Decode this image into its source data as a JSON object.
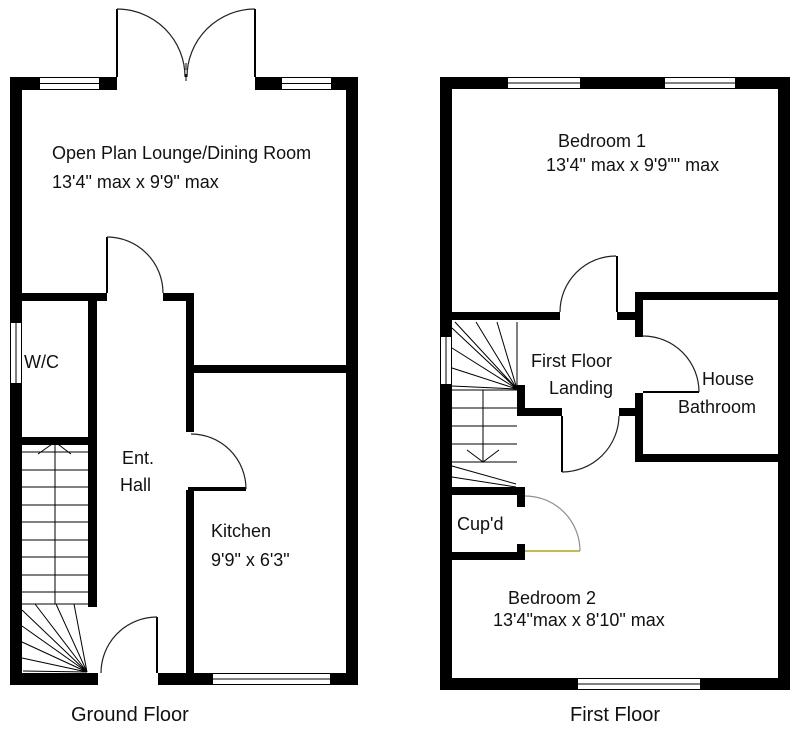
{
  "ground_floor": {
    "floor_label": "Ground Floor",
    "lounge": {
      "line1": "Open Plan Lounge/Dining Room",
      "line2": "13'4\" max x 9'9\" max"
    },
    "wc": {
      "label": "W/C"
    },
    "hall": {
      "line1": "Ent.",
      "line2": "Hall"
    },
    "kitchen": {
      "line1": "Kitchen",
      "line2": "9'9\" x 6'3\""
    }
  },
  "first_floor": {
    "floor_label": "First Floor",
    "bedroom1": {
      "line1": "Bedroom 1",
      "line2": "13'4\" max x 9'9\"\" max"
    },
    "landing": {
      "line1": "First Floor",
      "line2": "Landing"
    },
    "bathroom": {
      "line1": "House",
      "line2": "Bathroom"
    },
    "cupboard": {
      "label": "Cup'd"
    },
    "bedroom2": {
      "line1": "Bedroom 2",
      "line2": "13'4\"max x 8'10\" max"
    }
  },
  "colors": {
    "wall": "#000000",
    "background": "#ffffff",
    "door_arc": "#222222",
    "cupboard_door_leaf": "#b3a01e",
    "cupboard_door_arc": "#909090"
  }
}
